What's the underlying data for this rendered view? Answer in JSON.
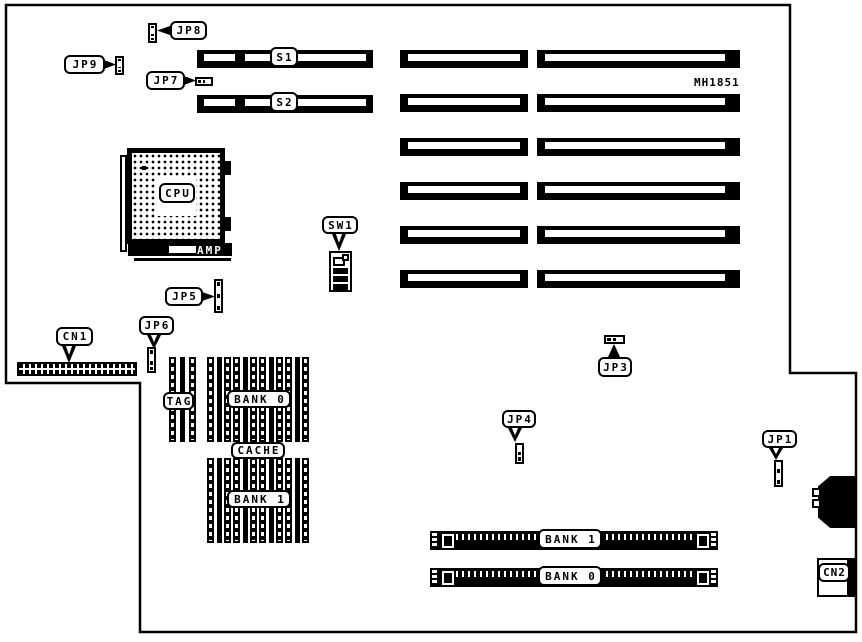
{
  "board": {
    "part_number": "MH1851",
    "colors": {
      "line": "#000000",
      "background": "#ffffff"
    }
  },
  "components": {
    "jp1": "JP1",
    "jp3": "JP3",
    "jp4": "JP4",
    "jp5": "JP5",
    "jp6": "JP6",
    "jp7": "JP7",
    "jp8": "JP8",
    "jp9": "JP9",
    "s1": "S1",
    "s2": "S2",
    "cpu": "CPU",
    "amp": "AMP",
    "sw1": "SW1",
    "cn1": "CN1",
    "cn2": "CN2",
    "tag": "TAG",
    "cache": "CACHE",
    "cache_bank0": "BANK 0",
    "cache_bank1": "BANK 1",
    "simm_bank1": "BANK 1",
    "simm_bank0": "BANK 0"
  }
}
